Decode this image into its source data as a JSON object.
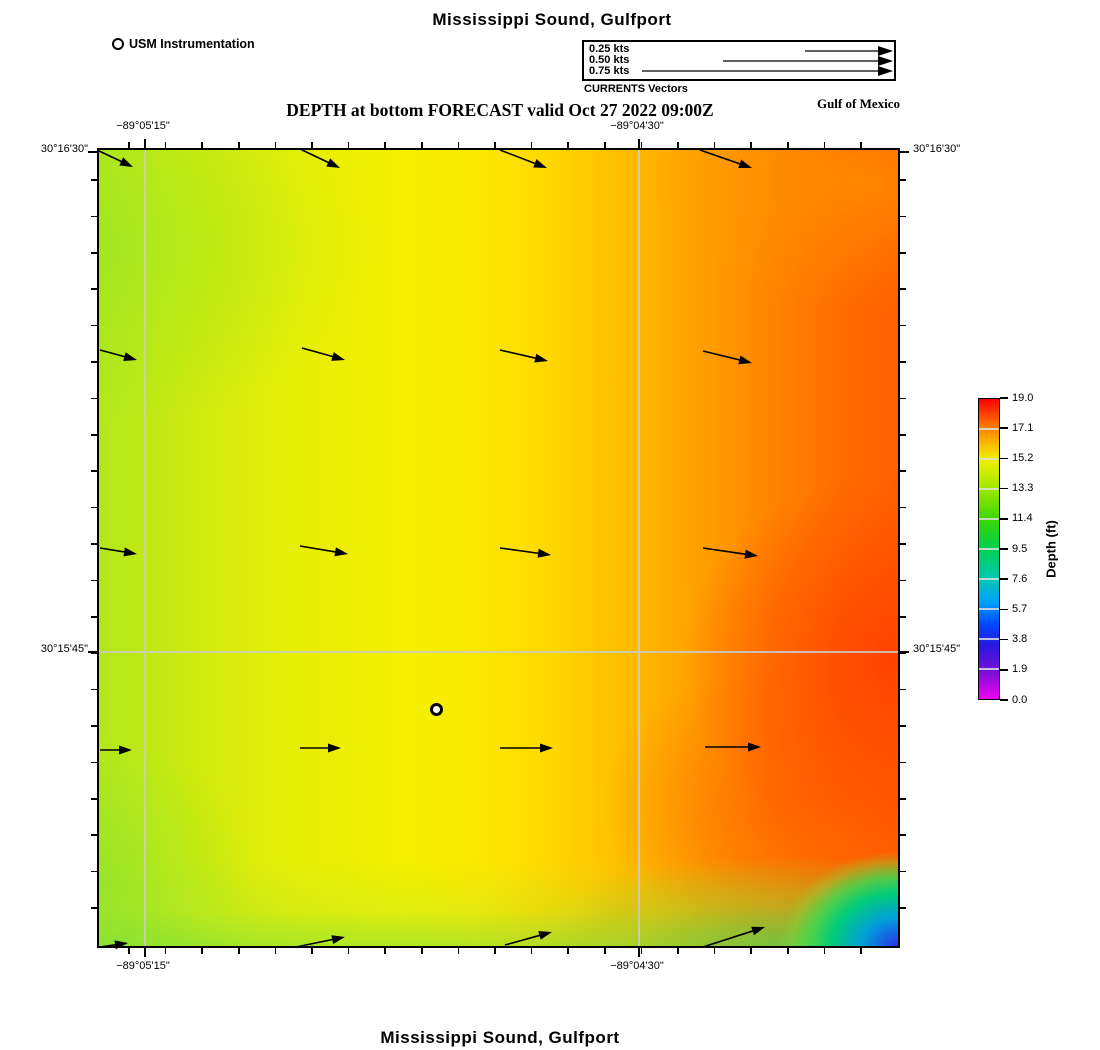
{
  "titles": {
    "top": "Mississippi Sound, Gulfport",
    "subtitle": "DEPTH at bottom FORECAST valid Oct 27 2022 09:00Z",
    "region_label": "Gulf of Mexico",
    "bottom": "Mississippi Sound, Gulfport"
  },
  "legend": {
    "station_label": "USM Instrumentation",
    "vectors_caption": "CURRENTS Vectors",
    "arrow_tip_x": 893,
    "speeds": [
      {
        "label": "0.25 kts",
        "x1": 805,
        "y": 51
      },
      {
        "label": "0.50 kts",
        "x1": 723,
        "y": 61
      },
      {
        "label": "0.75 kts",
        "x1": 642,
        "y": 71
      }
    ]
  },
  "map": {
    "left": 97,
    "top": 148,
    "width": 803,
    "height": 800,
    "gridlines": {
      "x_rel": [
        46,
        540
      ],
      "y_rel": [
        502
      ]
    },
    "major_y_rel": [
      2,
      502
    ],
    "ticks": {
      "x_start": 30,
      "x_spacing": 36.6,
      "y_start": 30,
      "y_spacing": 36.4,
      "count": 22
    },
    "x_labels": [
      {
        "text": "−89°05'15\"",
        "x": 143
      },
      {
        "text": "−89°04'30\"",
        "x": 637
      }
    ],
    "y_labels": [
      {
        "text": "30°16'30\"",
        "y": 150
      },
      {
        "text": "30°15'45\"",
        "y": 650
      }
    ],
    "station": {
      "x": 437,
      "y": 710
    },
    "current_arrows": [
      {
        "x1": 97,
        "y1": 150,
        "x2": 133,
        "y2": 167
      },
      {
        "x1": 300,
        "y1": 149,
        "x2": 340,
        "y2": 168
      },
      {
        "x1": 500,
        "y1": 150,
        "x2": 547,
        "y2": 168
      },
      {
        "x1": 700,
        "y1": 150,
        "x2": 752,
        "y2": 168
      },
      {
        "x1": 100,
        "y1": 350,
        "x2": 137,
        "y2": 360
      },
      {
        "x1": 302,
        "y1": 348,
        "x2": 345,
        "y2": 360
      },
      {
        "x1": 500,
        "y1": 350,
        "x2": 548,
        "y2": 361
      },
      {
        "x1": 703,
        "y1": 351,
        "x2": 752,
        "y2": 363
      },
      {
        "x1": 100,
        "y1": 548,
        "x2": 137,
        "y2": 554
      },
      {
        "x1": 300,
        "y1": 546,
        "x2": 348,
        "y2": 554
      },
      {
        "x1": 500,
        "y1": 548,
        "x2": 551,
        "y2": 555
      },
      {
        "x1": 703,
        "y1": 548,
        "x2": 758,
        "y2": 556
      },
      {
        "x1": 100,
        "y1": 750,
        "x2": 132,
        "y2": 750
      },
      {
        "x1": 300,
        "y1": 748,
        "x2": 341,
        "y2": 748
      },
      {
        "x1": 500,
        "y1": 748,
        "x2": 553,
        "y2": 748
      },
      {
        "x1": 705,
        "y1": 747,
        "x2": 761,
        "y2": 747
      },
      {
        "x1": 100,
        "y1": 947,
        "x2": 128,
        "y2": 943
      },
      {
        "x1": 296,
        "y1": 947,
        "x2": 345,
        "y2": 937
      },
      {
        "x1": 505,
        "y1": 945,
        "x2": 552,
        "y2": 932
      },
      {
        "x1": 703,
        "y1": 947,
        "x2": 765,
        "y2": 927
      }
    ]
  },
  "colorbar": {
    "title": "Depth (ft)",
    "left": 978,
    "top": 398,
    "width": 22,
    "height": 302,
    "tick_labels": [
      "19.0",
      "17.1",
      "15.2",
      "13.3",
      "11.4",
      "9.5",
      "7.6",
      "5.7",
      "3.8",
      "1.9",
      "0.0"
    ],
    "gradient": [
      {
        "p": 0,
        "c": "#fa0000"
      },
      {
        "p": 10,
        "c": "#ff8400"
      },
      {
        "p": 20,
        "c": "#f0f000"
      },
      {
        "p": 30,
        "c": "#9fe800"
      },
      {
        "p": 40,
        "c": "#3bd800"
      },
      {
        "p": 50,
        "c": "#00d050"
      },
      {
        "p": 60,
        "c": "#00c8b4"
      },
      {
        "p": 68,
        "c": "#009fff"
      },
      {
        "p": 75,
        "c": "#0048ff"
      },
      {
        "p": 82,
        "c": "#2818e0"
      },
      {
        "p": 91,
        "c": "#7a10d8"
      },
      {
        "p": 100,
        "c": "#f000f0"
      }
    ]
  },
  "chart_data": {
    "type": "heatmap",
    "title": "Mississippi Sound, Gulfport",
    "subtitle": "DEPTH at bottom FORECAST valid Oct 27 2022 09:00Z",
    "region": "Gulf of Mexico",
    "colorbar_label": "Depth (ft)",
    "colorbar_range": [
      0.0,
      19.0
    ],
    "colorbar_ticks": [
      19.0,
      17.1,
      15.2,
      13.3,
      11.4,
      9.5,
      7.6,
      5.7,
      3.8,
      1.9,
      0.0
    ],
    "x_axis_ticks": [
      "−89°05'15\"",
      "−89°04'30\""
    ],
    "y_axis_ticks": [
      "30°16'30\"",
      "30°15'45\""
    ],
    "grid": true,
    "legend_position": "top",
    "depth_grid_ft_estimated": {
      "note": "approximate depths read from color field; rows north to south, cols west to east",
      "values": [
        [
          13.8,
          15.0,
          15.6,
          16.6,
          17.3
        ],
        [
          14.0,
          15.2,
          15.8,
          17.0,
          17.9
        ],
        [
          14.2,
          15.3,
          16.0,
          17.6,
          18.6
        ],
        [
          13.9,
          15.1,
          15.9,
          17.7,
          18.8
        ],
        [
          13.2,
          14.5,
          15.3,
          15.4,
          6.0
        ]
      ]
    },
    "vector_field": {
      "units": "kts",
      "legend_speeds": [
        0.25,
        0.5,
        0.75
      ],
      "description": "current vectors point eastward; tilted slightly south in northern rows, horizontal mid-map, tilted north-east along the southern edge",
      "station_marker": "USM Instrumentation at approx −89°04'49\", 30°15'40\""
    }
  }
}
